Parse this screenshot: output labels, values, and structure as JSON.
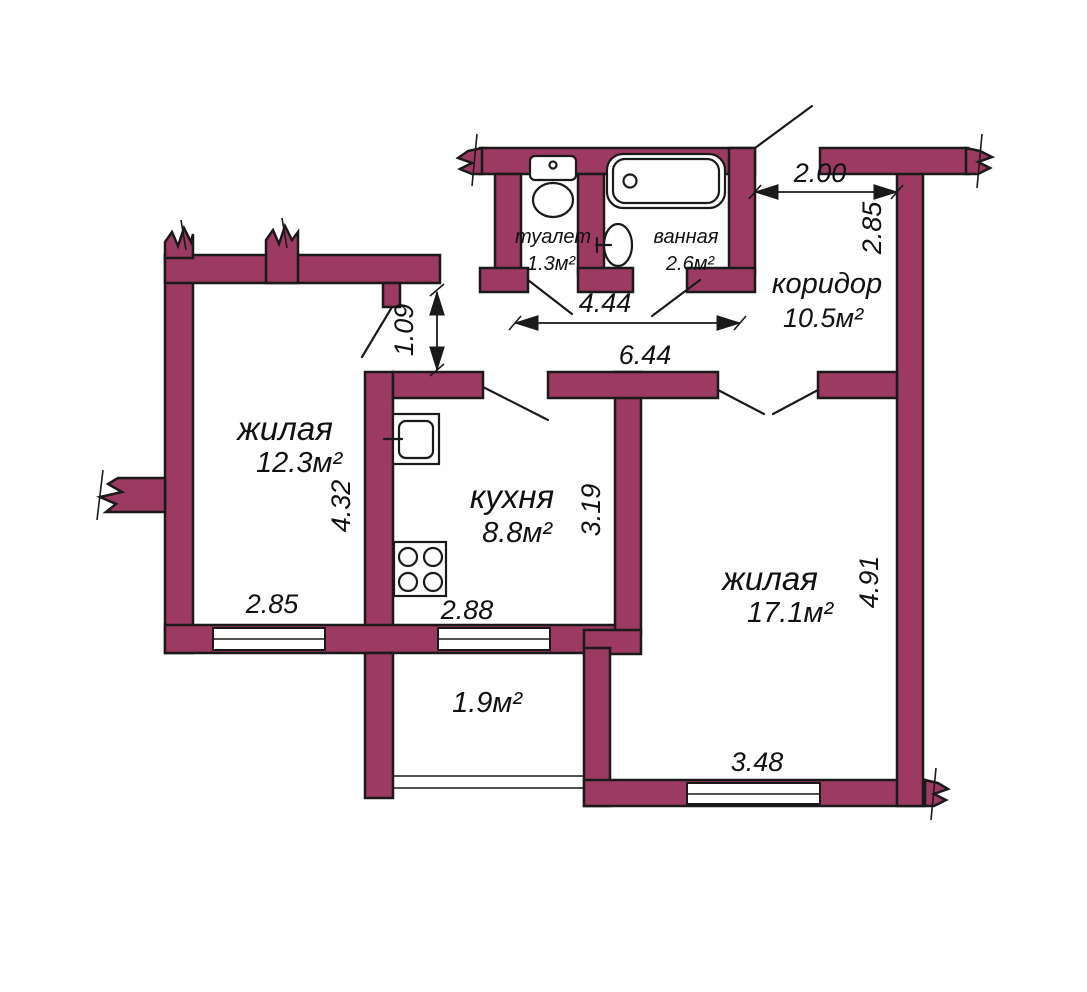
{
  "plan": {
    "colors": {
      "wall_fill": "#9d3a61",
      "line": "#1a1a1a",
      "background": "#ffffff",
      "fixture_fill": "#ffffff"
    },
    "rooms": {
      "toilet": {
        "name": "туалет",
        "area": "1.3м²"
      },
      "bathroom": {
        "name": "ванная",
        "area": "2.6м²"
      },
      "corridor": {
        "name": "коридор",
        "area": "10.5м²"
      },
      "living_small": {
        "name": "жилая",
        "area": "12.3м²"
      },
      "kitchen": {
        "name": "кухня",
        "area": "8.8м²"
      },
      "living_large": {
        "name": "жилая",
        "area": "17.1м²"
      },
      "balcony": {
        "area": "1.9м²"
      }
    },
    "dimensions": {
      "corridor_width": "2.00",
      "corridor_depth": "2.85",
      "hallway_length": "4.44",
      "inner_wall_length": "6.44",
      "doorway_offset": "1.09",
      "living_small_depth": "4.32",
      "kitchen_depth": "3.19",
      "living_large_depth": "4.91",
      "living_small_window": "2.85",
      "kitchen_window": "2.88",
      "living_large_window": "3.48"
    },
    "fixtures": {
      "toilet": "toilet-icon",
      "bathtub": "bathtub-icon",
      "washbasin": "washbasin-icon",
      "kitchen_sink": "kitchen-sink-icon",
      "stove": "stove-icon"
    }
  }
}
